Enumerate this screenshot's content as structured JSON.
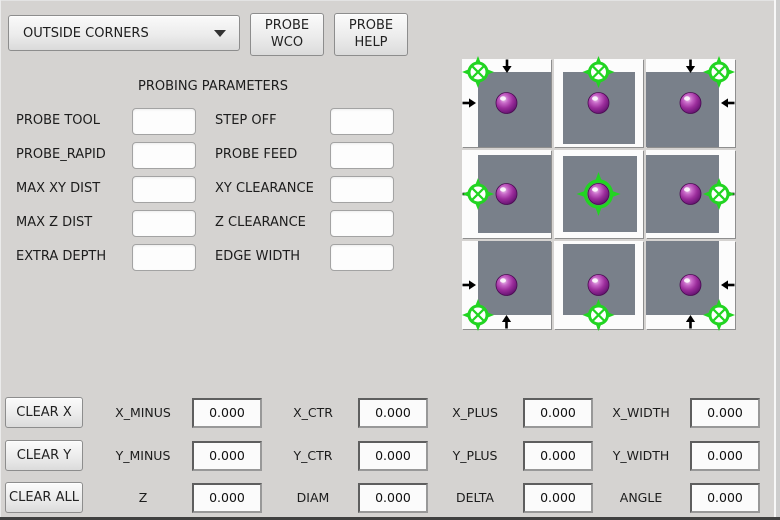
{
  "colors": {
    "window_bg": "#d5d3d1",
    "accent_green": "#22d422",
    "part_gray": "#79808a",
    "sphere_purple": "#9b2d9b",
    "arrow_black": "#000000"
  },
  "header": {
    "mode_select": {
      "value": "OUTSIDE CORNERS"
    },
    "probe_wco": {
      "line1": "PROBE",
      "line2": "WCO"
    },
    "probe_help": {
      "line1": "PROBE",
      "line2": "HELP"
    }
  },
  "probing_parameters": {
    "title": "PROBING PARAMETERS",
    "rows": [
      {
        "left": {
          "label": "PROBE TOOL",
          "value": ""
        },
        "right": {
          "label": "STEP OFF",
          "value": ""
        }
      },
      {
        "left": {
          "label": "PROBE_RAPID",
          "value": ""
        },
        "right": {
          "label": "PROBE FEED",
          "value": ""
        }
      },
      {
        "left": {
          "label": "MAX XY DIST",
          "value": ""
        },
        "right": {
          "label": "XY CLEARANCE",
          "value": ""
        }
      },
      {
        "left": {
          "label": "MAX Z DIST",
          "value": ""
        },
        "right": {
          "label": "Z CLEARANCE",
          "value": ""
        }
      },
      {
        "left": {
          "label": "EXTRA DEPTH",
          "value": ""
        },
        "right": {
          "label": "EDGE WIDTH",
          "value": ""
        }
      }
    ]
  },
  "probe_diagram": {
    "tiles": [
      {
        "position": "top-left"
      },
      {
        "position": "top"
      },
      {
        "position": "top-right"
      },
      {
        "position": "left"
      },
      {
        "position": "center"
      },
      {
        "position": "right"
      },
      {
        "position": "bottom-left"
      },
      {
        "position": "bottom"
      },
      {
        "position": "bottom-right"
      }
    ]
  },
  "results": {
    "buttons": [
      "CLEAR X",
      "CLEAR Y",
      "CLEAR ALL"
    ],
    "rows": [
      {
        "cells": [
          {
            "label": "X_MINUS",
            "value": "0.000"
          },
          {
            "label": "X_CTR",
            "value": "0.000"
          },
          {
            "label": "X_PLUS",
            "value": "0.000"
          },
          {
            "label": "X_WIDTH",
            "value": "0.000"
          }
        ]
      },
      {
        "cells": [
          {
            "label": "Y_MINUS",
            "value": "0.000"
          },
          {
            "label": "Y_CTR",
            "value": "0.000"
          },
          {
            "label": "Y_PLUS",
            "value": "0.000"
          },
          {
            "label": "Y_WIDTH",
            "value": "0.000"
          }
        ]
      },
      {
        "cells": [
          {
            "label": "Z",
            "value": "0.000"
          },
          {
            "label": "DIAM",
            "value": "0.000"
          },
          {
            "label": "DELTA",
            "value": "0.000"
          },
          {
            "label": "ANGLE",
            "value": "0.000"
          }
        ]
      }
    ]
  }
}
